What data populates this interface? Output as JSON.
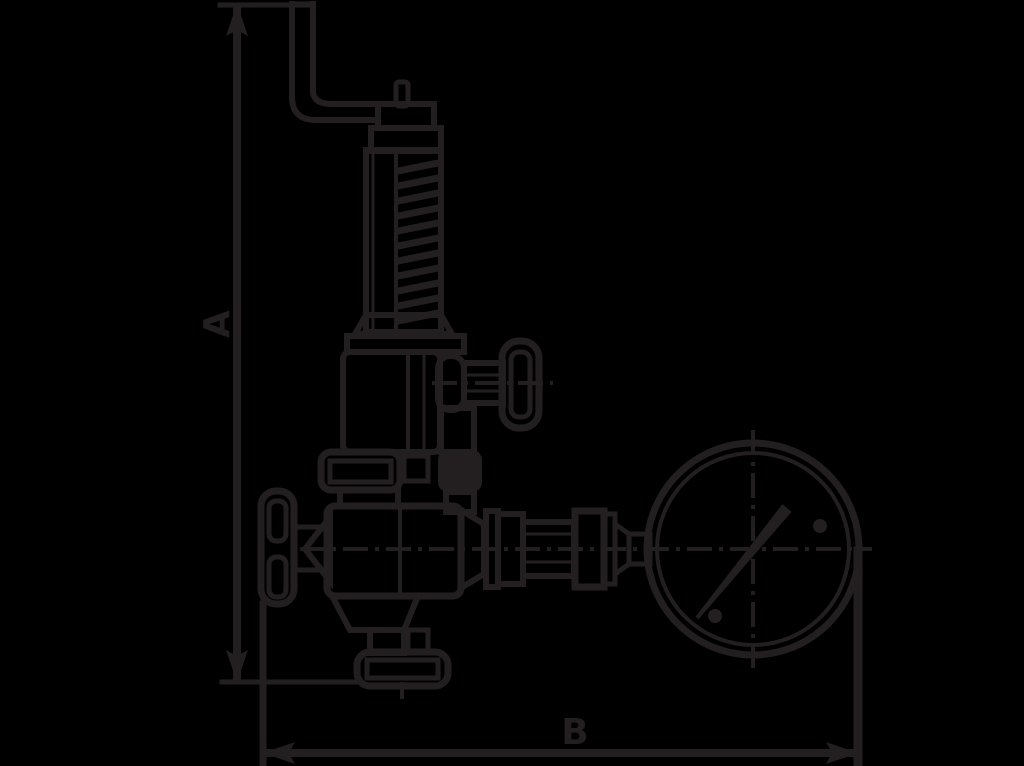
{
  "colors": {
    "background": "#000000",
    "ink": "#231f20"
  },
  "diagram": {
    "description": "Side-elevation technical line drawing of a spring-loaded safety valve with easing lever, side test handwheel, inlet handwheel, bottom flange and attached pressure gauge",
    "dimensions": {
      "vertical": {
        "label": "A"
      },
      "horizontal": {
        "label": "B"
      }
    }
  }
}
